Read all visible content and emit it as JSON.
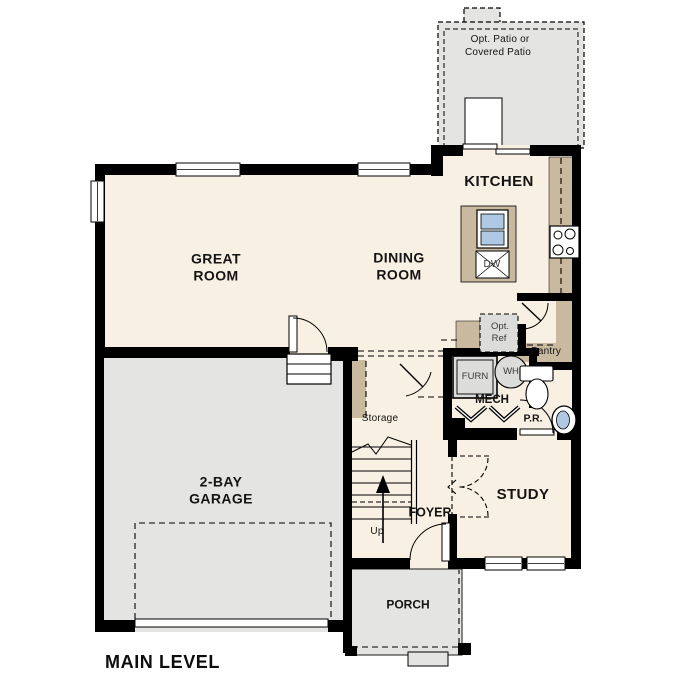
{
  "plan_title": "MAIN LEVEL",
  "colors": {
    "floor_cream": "#F8F0E2",
    "exterior_gray": "#E4E4E2",
    "counter_tan": "#C9B99E",
    "fixture_blue": "#AFC8E3",
    "optional_gray": "#DCDCDA",
    "wall_black": "#000000"
  },
  "rooms": {
    "kitchen": "KITCHEN",
    "great_room_line1": "GREAT",
    "great_room_line2": "ROOM",
    "dining_room_line1": "DINING",
    "dining_room_line2": "ROOM",
    "garage_line1": "2-BAY",
    "garage_line2": "GARAGE",
    "study": "STUDY",
    "foyer": "FOYER",
    "porch": "PORCH",
    "powder_room": "P.R.",
    "mech_closet": "MECH",
    "pantry": "Pantry",
    "storage": "Storage"
  },
  "annotations": {
    "patio_line1": "Opt. Patio or",
    "patio_line2": "Covered Patio",
    "opt_ref_line1": "Opt.",
    "opt_ref_line2": "Ref",
    "stairs_direction": "Up"
  },
  "fixtures": {
    "furnace": "FURN",
    "water_heater": "WH",
    "dishwasher": "DW"
  }
}
